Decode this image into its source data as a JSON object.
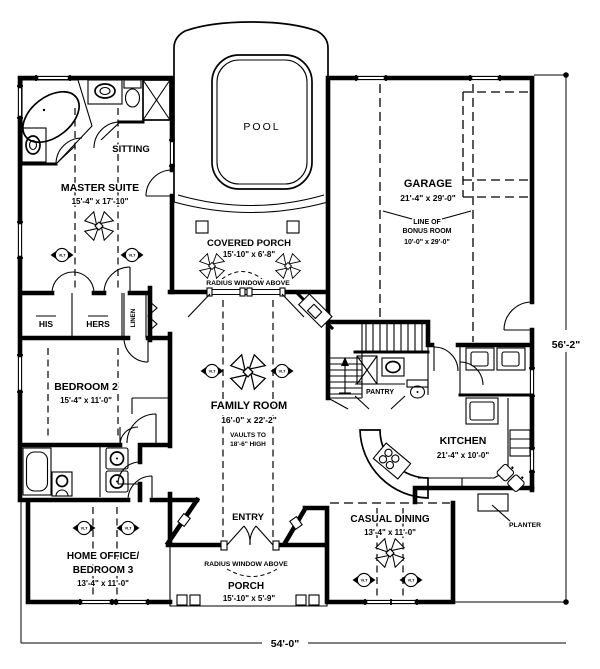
{
  "colors": {
    "ink": "#000000",
    "paper": "#ffffff"
  },
  "r": {
    "pool": {
      "name": "POOL"
    },
    "cporch": {
      "name": "COVERED PORCH",
      "dims": "15'-10\" x 6'-8\"",
      "note": "RADIUS WINDOW ABOVE"
    },
    "sitting": {
      "name": "SITTING"
    },
    "master": {
      "name": "MASTER SUITE",
      "dims": "15'-4\" x 17'-10\""
    },
    "his": {
      "name": "HIS"
    },
    "hers": {
      "name": "HERS"
    },
    "linen": {
      "name": "LINEN"
    },
    "bed2": {
      "name": "BEDROOM 2",
      "dims": "15'-4\" x 11'-0\""
    },
    "family": {
      "name": "FAMILY ROOM",
      "dims": "16'-0\" x 22'-2\"",
      "note1": "VAULTS TO",
      "note2": "18'-6\" HIGH"
    },
    "garage": {
      "name": "GARAGE",
      "dims": "21'-4\" x 29'-0\""
    },
    "bonus": {
      "l1": "LINE OF",
      "l2": "BONUS ROOM",
      "dims": "10'-0\" x 29'-0\""
    },
    "pantry": {
      "name": "PANTRY"
    },
    "kitchen": {
      "name": "KITCHEN",
      "dims": "21'-4\" x 10'-0\""
    },
    "dining": {
      "name": "CASUAL DINING",
      "dims": "13'-4\" x 11'-0\""
    },
    "entry": {
      "name": "ENTRY"
    },
    "office": {
      "l1": "HOME OFFICE/",
      "l2": "BEDROOM 3",
      "dims": "13'-4\" x 11'-0\""
    },
    "porch": {
      "name": "PORCH",
      "dims": "15'-10\" x 5'-9\"",
      "note": "RADIUS WINDOW ABOVE"
    },
    "planter": {
      "name": "PLANTER"
    }
  },
  "dims": {
    "overall_width": "54'-0\"",
    "overall_height": "56'-2\""
  },
  "sym": {
    "vault": "VLT"
  }
}
